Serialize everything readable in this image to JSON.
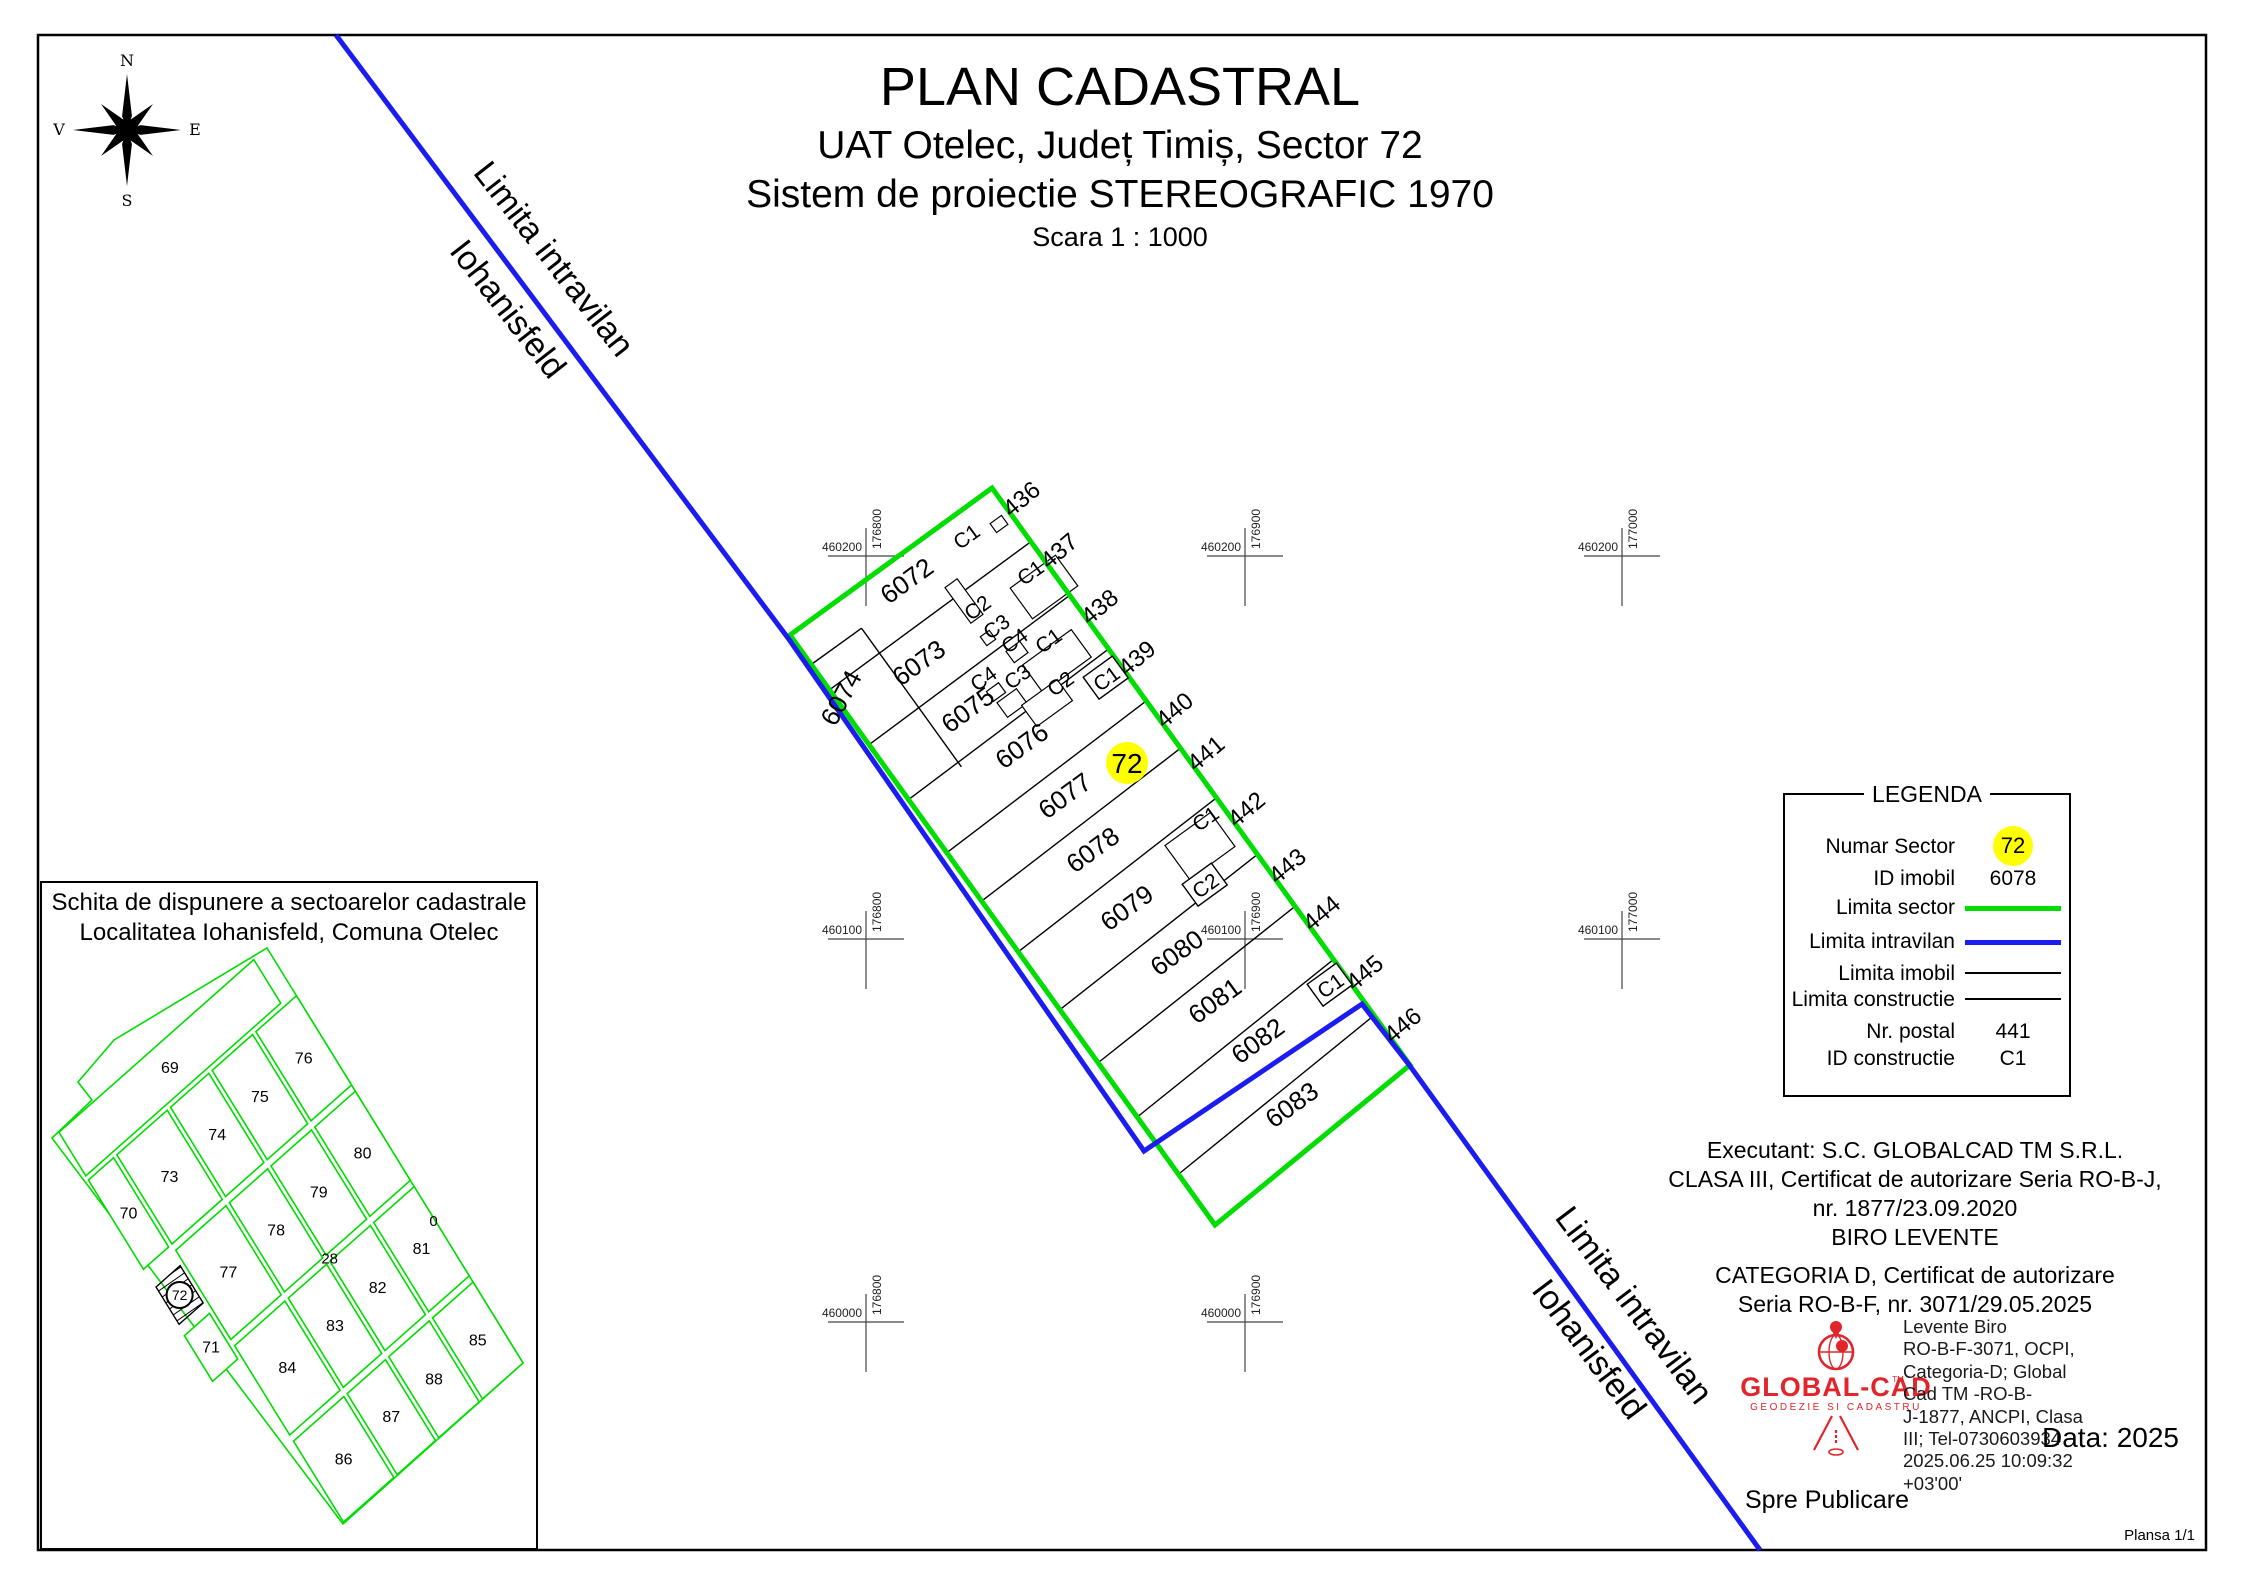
{
  "title_block": {
    "title": "PLAN CADASTRAL",
    "subtitle1": "UAT Otelec, Județ Timiș, Sector 72",
    "subtitle2": "Sistem de proiectie STEREOGRAFIC 1970",
    "scale": "Scara 1 : 1000"
  },
  "compass": {
    "n": "N",
    "s": "S",
    "e": "E",
    "w": "V"
  },
  "colors": {
    "sector_green": "#00dd00",
    "intravilan_blue": "#1c1cf0",
    "badge_yellow": "#ffff00",
    "logo_red": "#e1252b",
    "thin_line": "#000000"
  },
  "intravilan_labels": [
    {
      "line1": "Limita intravilan",
      "line2": "Iohanisfeld",
      "x1": 545,
      "y1": 266,
      "x2": 499,
      "y2": 316,
      "rot": 52
    },
    {
      "line1": "Limita intravilan",
      "line2": "Iohanisfeld",
      "x1": 1625,
      "y1": 1312,
      "x2": 1580,
      "y2": 1356,
      "rot": 53
    }
  ],
  "sector_badge": {
    "text": "72",
    "x": 1127,
    "y": 763,
    "r": 21
  },
  "parcels": [
    {
      "id": "6072",
      "x": 912,
      "y": 588,
      "rot": -36
    },
    {
      "id": "6073",
      "x": 924,
      "y": 670,
      "rot": -36
    },
    {
      "id": "6074",
      "x": 849,
      "y": 702,
      "rot": -62
    },
    {
      "id": "6075",
      "x": 973,
      "y": 717,
      "rot": -36
    },
    {
      "id": "6076",
      "x": 1027,
      "y": 753,
      "rot": -36
    },
    {
      "id": "6077",
      "x": 1070,
      "y": 803,
      "rot": -36
    },
    {
      "id": "6078",
      "x": 1098,
      "y": 857,
      "rot": -36
    },
    {
      "id": "6079",
      "x": 1132,
      "y": 915,
      "rot": -36
    },
    {
      "id": "6080",
      "x": 1182,
      "y": 960,
      "rot": -36
    },
    {
      "id": "6081",
      "x": 1220,
      "y": 1008,
      "rot": -36
    },
    {
      "id": "6082",
      "x": 1263,
      "y": 1048,
      "rot": -36
    },
    {
      "id": "6083",
      "x": 1297,
      "y": 1112,
      "rot": -36
    }
  ],
  "street_numbers": [
    {
      "n": "436",
      "f": 0.048
    },
    {
      "n": "437",
      "f": 0.138
    },
    {
      "n": "438",
      "f": 0.235
    },
    {
      "n": "439",
      "f": 0.324
    },
    {
      "n": "440",
      "f": 0.414
    },
    {
      "n": "441",
      "f": 0.489
    },
    {
      "n": "442",
      "f": 0.586
    },
    {
      "n": "443",
      "f": 0.684
    },
    {
      "n": "444",
      "f": 0.766
    },
    {
      "n": "445",
      "f": 0.869
    },
    {
      "n": "446",
      "f": 0.96
    }
  ],
  "constructions": [
    {
      "label": "C1",
      "x": 966,
      "y": 536,
      "boxed": false
    },
    {
      "label": "C1",
      "x": 1030,
      "y": 572,
      "boxed": false
    },
    {
      "label": "C2",
      "x": 977,
      "y": 607,
      "boxed": false
    },
    {
      "label": "C3",
      "x": 996,
      "y": 626,
      "boxed": false
    },
    {
      "label": "C4",
      "x": 1014,
      "y": 640,
      "boxed": false
    },
    {
      "label": "C1",
      "x": 1048,
      "y": 640,
      "boxed": false
    },
    {
      "label": "C4",
      "x": 983,
      "y": 678,
      "boxed": false
    },
    {
      "label": "C3",
      "x": 1017,
      "y": 676,
      "boxed": false
    },
    {
      "label": "C2",
      "x": 1060,
      "y": 683,
      "boxed": false
    },
    {
      "label": "C1",
      "x": 1106,
      "y": 678,
      "boxed": true
    },
    {
      "label": "C1",
      "x": 1205,
      "y": 818,
      "boxed": false
    },
    {
      "label": "C2",
      "x": 1205,
      "y": 885,
      "boxed": true
    },
    {
      "label": "C1",
      "x": 1330,
      "y": 985,
      "boxed": true
    }
  ],
  "buildings": [
    {
      "cx": 999,
      "cy": 524,
      "w": 14,
      "h": 11
    },
    {
      "cx": 1044,
      "cy": 587,
      "w": 56,
      "h": 38
    },
    {
      "cx": 964,
      "cy": 601,
      "w": 15,
      "h": 44
    },
    {
      "cx": 988,
      "cy": 638,
      "w": 11,
      "h": 11
    },
    {
      "cx": 1017,
      "cy": 652,
      "w": 17,
      "h": 14
    },
    {
      "cx": 1057,
      "cy": 661,
      "w": 60,
      "h": 34
    },
    {
      "cx": 996,
      "cy": 692,
      "w": 15,
      "h": 12
    },
    {
      "cx": 1012,
      "cy": 703,
      "w": 24,
      "h": 18
    },
    {
      "cx": 1047,
      "cy": 703,
      "w": 44,
      "h": 26
    },
    {
      "cx": 1200,
      "cy": 846,
      "w": 56,
      "h": 42
    }
  ],
  "grid_crosses": [
    {
      "x": 866,
      "y": 556,
      "xl": "460200",
      "yl": "176800"
    },
    {
      "x": 1245,
      "y": 556,
      "xl": "460200",
      "yl": "176900"
    },
    {
      "x": 1622,
      "y": 556,
      "xl": "460200",
      "yl": "177000"
    },
    {
      "x": 866,
      "y": 939,
      "xl": "460100",
      "yl": "176800"
    },
    {
      "x": 1245,
      "y": 939,
      "xl": "460100",
      "yl": "176900"
    },
    {
      "x": 1622,
      "y": 939,
      "xl": "460100",
      "yl": "177000"
    },
    {
      "x": 866,
      "y": 1322,
      "xl": "460000",
      "yl": "176800"
    },
    {
      "x": 1245,
      "y": 1322,
      "xl": "460000",
      "yl": "176900"
    }
  ],
  "legend": {
    "title": "LEGENDA",
    "rows": [
      {
        "label": "Numar Sector",
        "type": "badge",
        "value": "72"
      },
      {
        "label": "ID imobil",
        "type": "text",
        "value": "6078"
      },
      {
        "label": "Limita sector",
        "type": "line",
        "value": "",
        "color": "green"
      },
      {
        "label": "Limita intravilan",
        "type": "line",
        "value": "",
        "color": "blue"
      },
      {
        "label": "Limita imobil",
        "type": "thinline",
        "value": ""
      },
      {
        "label": "Limita constructie",
        "type": "thinline",
        "value": ""
      },
      {
        "label": "Nr. postal",
        "type": "text",
        "value": "441"
      },
      {
        "label": "ID constructie",
        "type": "text",
        "value": "C1"
      }
    ]
  },
  "inset": {
    "title1": "Schita de dispunere a sectoarelor cadastrale",
    "title2": "Localitatea Iohanisfeld, Comuna Otelec",
    "blocks": [
      {
        "label": "76",
        "s0": 0.115,
        "s1": 0.33,
        "t0": 0.0,
        "t1": 0.185
      },
      {
        "label": "75",
        "s0": 0.115,
        "s1": 0.33,
        "t0": 0.2,
        "t1": 0.385
      },
      {
        "label": "74",
        "s0": 0.115,
        "s1": 0.33,
        "t0": 0.4,
        "t1": 0.575
      },
      {
        "label": "73",
        "s0": 0.115,
        "s1": 0.33,
        "t0": 0.59,
        "t1": 0.82
      },
      {
        "label": "70",
        "s0": 0.115,
        "s1": 0.33,
        "t0": 0.835,
        "t1": 0.95
      },
      {
        "label": "80",
        "s0": 0.345,
        "s1": 0.56,
        "t0": 0.0,
        "t1": 0.185
      },
      {
        "label": "79",
        "s0": 0.345,
        "s1": 0.56,
        "t0": 0.2,
        "t1": 0.385
      },
      {
        "label": "78",
        "s0": 0.345,
        "s1": 0.56,
        "t0": 0.4,
        "t1": 0.575
      },
      {
        "label": "77",
        "s0": 0.345,
        "s1": 0.56,
        "t0": 0.59,
        "t1": 0.82
      },
      {
        "label": "71",
        "s0": 0.49,
        "s1": 0.6,
        "t0": 0.835,
        "t1": 0.95
      },
      {
        "label": "81",
        "s0": 0.575,
        "s1": 0.79,
        "t0": 0.0,
        "t1": 0.185
      },
      {
        "label": "82",
        "s0": 0.575,
        "s1": 0.79,
        "t0": 0.2,
        "t1": 0.385
      },
      {
        "label": "83",
        "s0": 0.575,
        "s1": 0.79,
        "t0": 0.4,
        "t1": 0.575
      },
      {
        "label": "84",
        "s0": 0.575,
        "s1": 0.79,
        "t0": 0.59,
        "t1": 0.82
      },
      {
        "label": "85",
        "s0": 0.805,
        "s1": 1.0,
        "t0": 0.0,
        "t1": 0.185
      },
      {
        "label": "88",
        "s0": 0.805,
        "s1": 1.0,
        "t0": 0.2,
        "t1": 0.385
      },
      {
        "label": "87",
        "s0": 0.805,
        "s1": 1.0,
        "t0": 0.4,
        "t1": 0.575
      },
      {
        "label": "86",
        "s0": 0.805,
        "s1": 1.0,
        "t0": 0.59,
        "t1": 0.82
      },
      {
        "label": "69",
        "s0": 0.0,
        "s1": 0.105,
        "t0": 0.06,
        "t1": 0.95
      }
    ],
    "hatched_block": {
      "label": "72",
      "s0": 0.375,
      "s1": 0.465,
      "t0": 0.835,
      "t1": 0.945
    },
    "texts": [
      {
        "label": "28",
        "s": 0.57,
        "t": 0.38
      },
      {
        "label": "0",
        "s": 0.655,
        "t": 0.005
      }
    ]
  },
  "executant": {
    "lines": [
      "Executant: S.C. GLOBALCAD TM S.R.L.",
      "CLASA III, Certificat de autorizare Seria RO-B-J,",
      "nr. 1877/23.09.2020",
      "BIRO LEVENTE",
      "CATEGORIA D, Certificat de autorizare",
      "Seria RO-B-F, nr. 3071/29.05.2025"
    ]
  },
  "signature": {
    "lines": [
      "Levente Biro",
      "RO-B-F-3071, OCPI,",
      "Categoria-D; Global",
      "Cad TM -RO-B-",
      "J-1877, ANCPI, Clasa",
      "III; Tel-0730603934",
      "2025.06.25 10:09:32",
      "+03'00'"
    ]
  },
  "logo": {
    "name": "GLOBAL-CAD",
    "tm": "TM",
    "tagline": "GEODEZIE SI CADASTRU"
  },
  "footer": {
    "spre": "Spre Publicare",
    "data": "Data: 2025",
    "plansa": "Plansa 1/1"
  }
}
